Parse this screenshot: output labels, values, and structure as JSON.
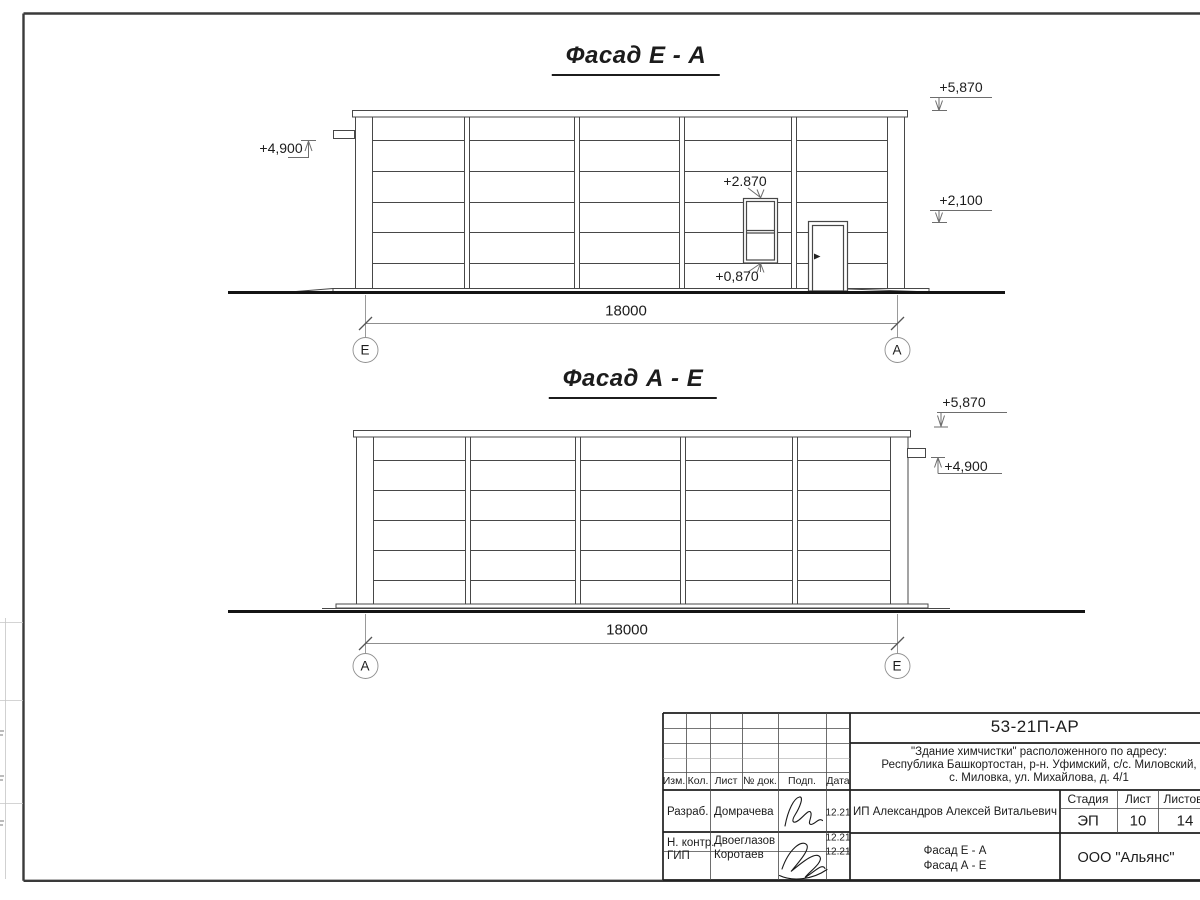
{
  "ink_color": "#1c1c1c",
  "facade1": {
    "title": "Фасад Е - А",
    "dim": "18000",
    "axis_left": "Е",
    "axis_right": "А",
    "marks": {
      "left": "+4,900",
      "top_right": "+5,870",
      "mid_right": "+2,100",
      "window_top": "+2.870",
      "window_bottom": "+0,870"
    }
  },
  "facade2": {
    "title": "Фасад А - Е",
    "dim": "18000",
    "axis_left": "А",
    "axis_right": "Е",
    "marks": {
      "top_right": "+5,870",
      "right": "+4,900"
    }
  },
  "titleblock": {
    "doc_code": "53-21П-АР",
    "address_line1": "\"Здание химчистки\" расположенного по адресу:",
    "address_line2": "Республика Башкортостан, р-н. Уфимский, с/с. Миловский,",
    "address_line3": "с. Миловка, ул. Михайлова, д. 4/1",
    "client": "ИП Александров Алексей Витальевич",
    "stage_label": "Стадия",
    "sheet_label": "Лист",
    "sheets_label": "Листов",
    "stage": "ЭП",
    "sheet_no": "10",
    "sheets_total": "14",
    "content_line1": "Фасад Е - А",
    "content_line2": "Фасад А - Е",
    "company": "ООО \"Альянс\"",
    "cols": {
      "izm": "Изм.",
      "kol": "Кол.",
      "list": "Лист",
      "doc": "№ док.",
      "podp": "Подп.",
      "data": "Дата"
    },
    "rows": [
      {
        "role": "Разраб.",
        "name": "Домрачева",
        "date": "12.21"
      },
      {
        "role": "Н. контр.",
        "name": "Двоеглазов",
        "date": "12.21"
      },
      {
        "role": "ГИП",
        "name": "Коротаев",
        "date": "12.21"
      }
    ]
  }
}
